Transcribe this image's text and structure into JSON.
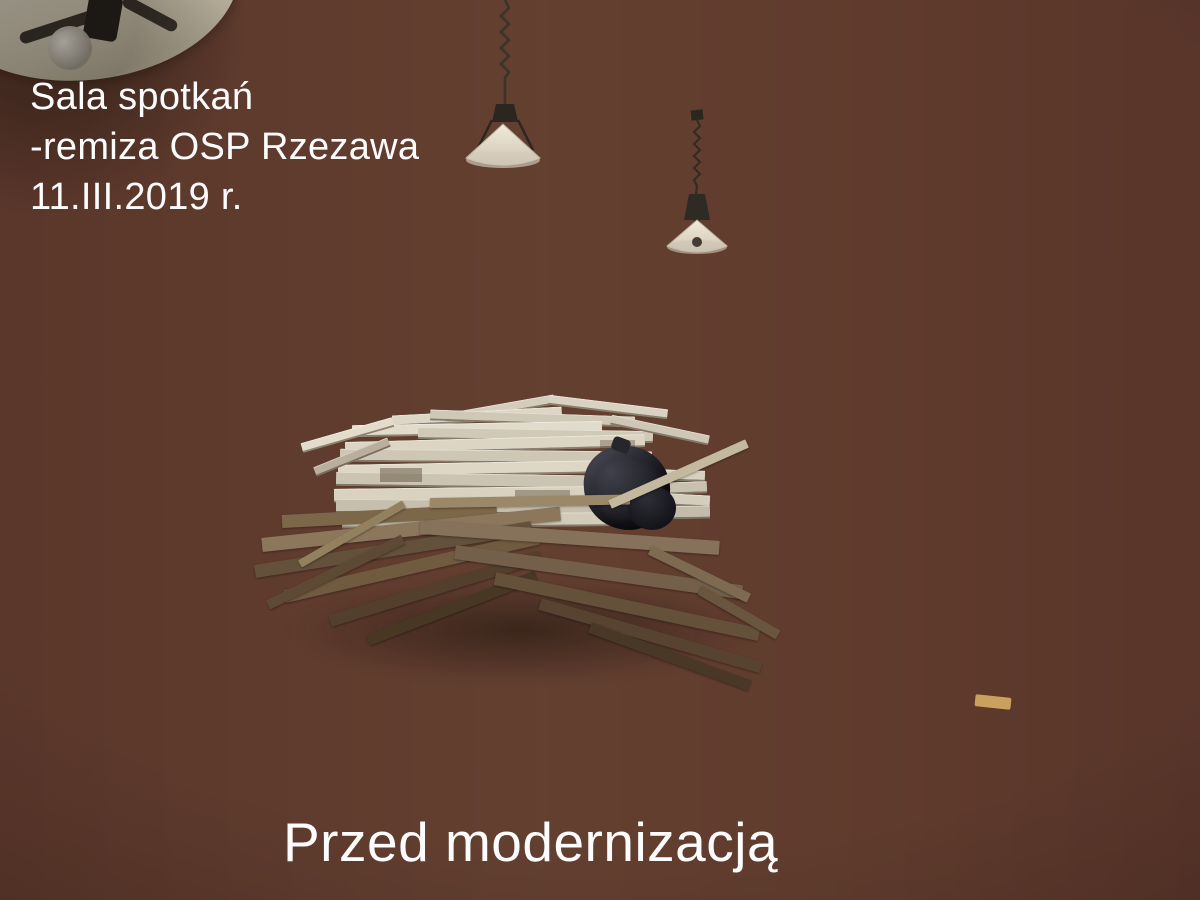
{
  "image": {
    "type": "photograph",
    "subject": "Meeting hall interior with renovation debris, wood panel wainscot, lace curtains and staircase railing",
    "width_px": 1200,
    "height_px": 900
  },
  "overlay": {
    "title_lines": [
      "Sala spotkań",
      "-remiza OSP Rzezawa",
      "11.III.2019 r."
    ],
    "caption": "Przed modernizacją",
    "text_color": "#fcfcfc"
  },
  "palette": {
    "ceiling": "#dbd7ce",
    "wall_yellow_left": "#c0af5e",
    "wall_yellow_right": "#d0c994",
    "wall_gray": "#989489",
    "wall_green": "#a9b28c",
    "corner_strip_olive": "#4f5a2e",
    "wainscot_wood": "#9a6230",
    "door_dark": "#201409",
    "window_glow": "#f7f4e2",
    "radiator_white": "#e9e6de",
    "curtain_white": "rgba(255,255,255,0.4)",
    "floor_dark": "#3a2b21",
    "floor_sheen_gray": "#8d8679",
    "beam_dark": "#3c2e20",
    "stairs_maroon": "#4c2f2b",
    "rail_wood": "#c08448",
    "white_planks": "#d8d1c0",
    "debris_brown": "#70593f",
    "trash_bag_black": "#1a1a20"
  }
}
